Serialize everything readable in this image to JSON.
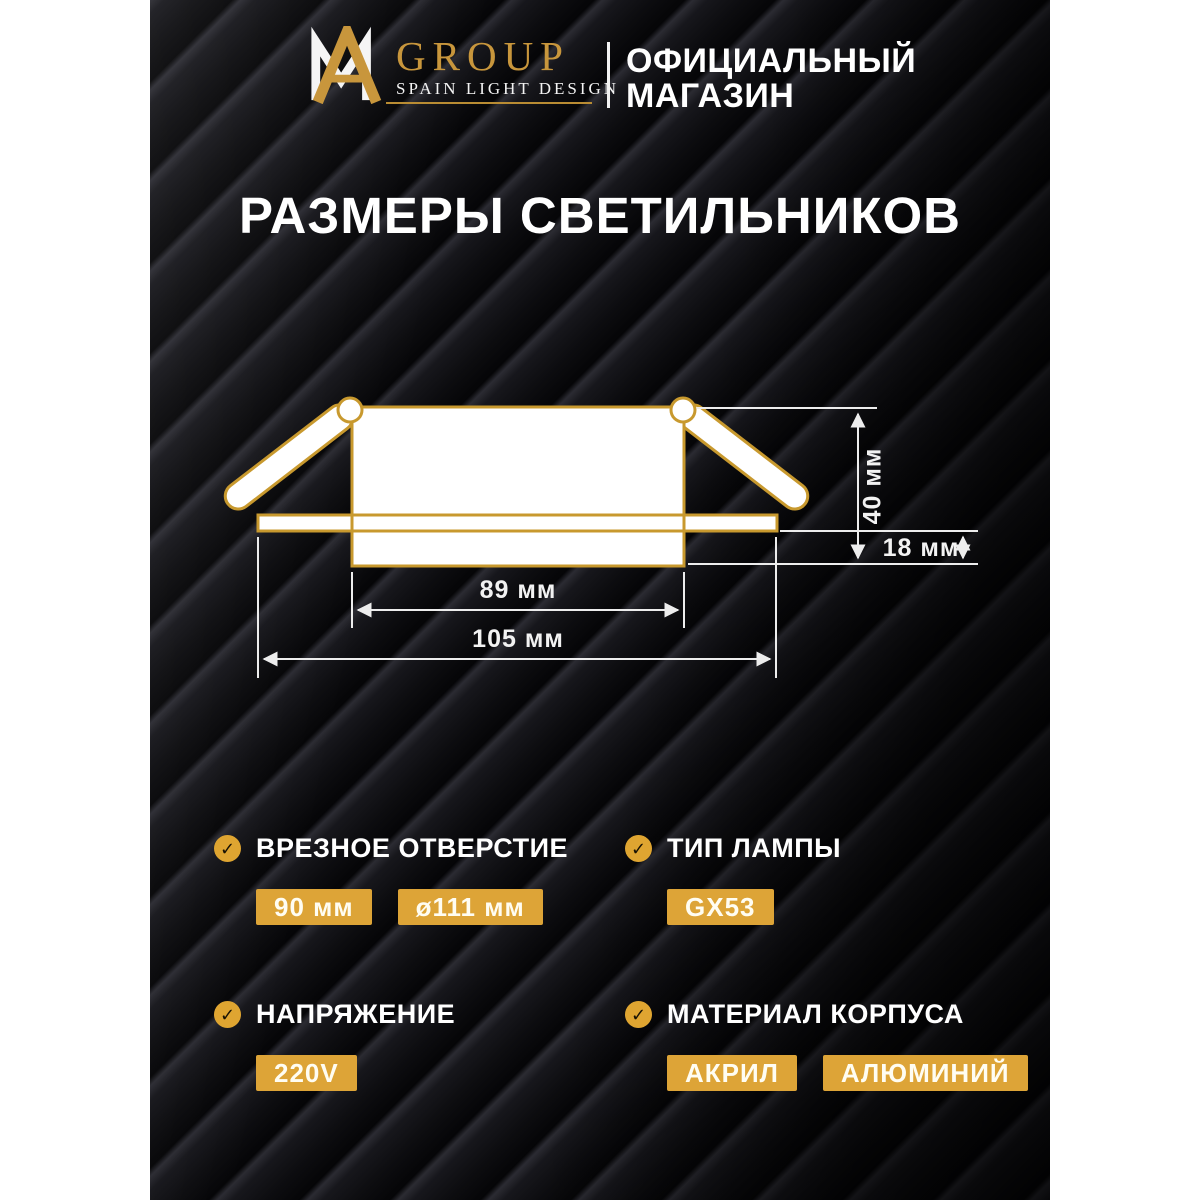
{
  "header": {
    "brand": {
      "monogram": "AM",
      "name": "GROUP",
      "tagline": "SPAIN LIGHT DESIGN"
    },
    "store": {
      "line1": "ОФИЦИАЛЬНЫЙ",
      "line2": "МАГАЗИН"
    }
  },
  "title": "РАЗМЕРЫ СВЕТИЛЬНИКОВ",
  "diagram": {
    "description": "Cross-section of recessed GX53 downlight with spring clips",
    "dim_height": "40 мм",
    "dim_recess": "18 мм",
    "dim_body": "89 мм",
    "dim_overall": "105 мм"
  },
  "specs": [
    {
      "label": "ВРЕЗНОЕ ОТВЕРСТИЕ",
      "values": [
        "90 мм",
        "ø111 мм"
      ]
    },
    {
      "label": "ТИП ЛАМПЫ",
      "values": [
        "GX53"
      ]
    },
    {
      "label": "НАПРЯЖЕНИЕ",
      "values": [
        "220V"
      ]
    },
    {
      "label": "МАТЕРИАЛ КОРПУСА",
      "values": [
        "АКРИЛ",
        "АЛЮМИНИЙ"
      ]
    }
  ],
  "colors": {
    "gold_badge": "#DDA437",
    "gold_outline": "#C8992E",
    "background": "#0B0B0E",
    "text": "#FFFFFF"
  },
  "check_glyph": "✓"
}
